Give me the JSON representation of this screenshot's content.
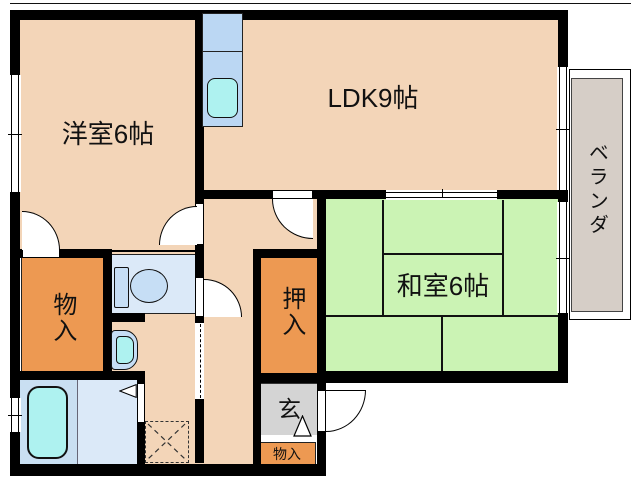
{
  "floorplan": {
    "type": "japanese-apartment-madori",
    "rooms": {
      "western": {
        "label": "洋室6帖"
      },
      "ldk": {
        "label": "LDK9帖"
      },
      "japanese": {
        "label": "和室6帖"
      },
      "veranda": {
        "label": "ベランダ"
      },
      "storage_left": {
        "label": "物入"
      },
      "oshiire_closet": {
        "label": "押入"
      },
      "entrance": {
        "label": "玄"
      },
      "storage_entrance": {
        "label": "物入"
      }
    },
    "fixtures": [
      "kitchen-sink-unit",
      "toilet",
      "washbasin",
      "bathtub",
      "washing-machine-pan",
      "entrance-step-triangle",
      "bath-door-triangle"
    ],
    "colors": {
      "wall": "#000000",
      "floor_beige": "#F3D5B8",
      "tatami_green": "#CBF3B4",
      "storage_orange": "#ED9952",
      "entrance_gray": "#D4D4D4",
      "veranda_taupe": "#D6CEC7",
      "fixture_blue": "#BBD7F3",
      "bath_floor_blue": "#C9DFF2",
      "room_floor_blue": "#DBE9F8",
      "water_cyan": "#AEF2F0"
    }
  }
}
